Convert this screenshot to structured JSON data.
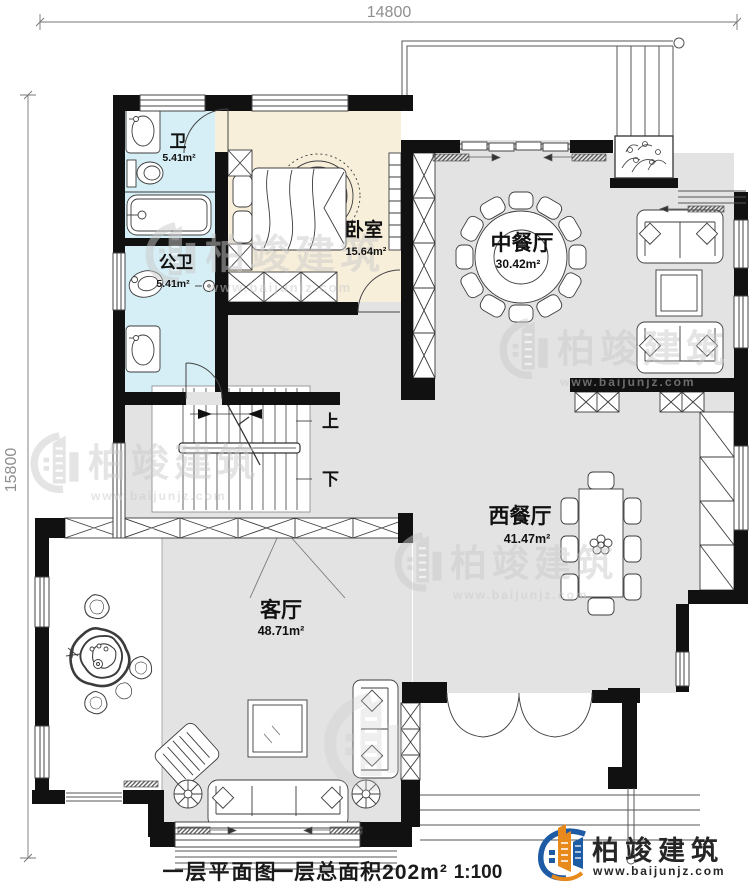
{
  "dimensions": {
    "top": "14800",
    "left": "15800"
  },
  "rooms": {
    "bath": {
      "name": "卫",
      "area": "5.41m²"
    },
    "public_bath": {
      "name": "公卫",
      "area": "5.41m²"
    },
    "bedroom": {
      "name": "卧室",
      "area": "15.64m²"
    },
    "chinese_dining": {
      "name": "中餐厅",
      "area": "30.42m²"
    },
    "western_dining": {
      "name": "西餐厅",
      "area": "41.47m²"
    },
    "living": {
      "name": "客厅",
      "area": "48.71m²"
    }
  },
  "stairs": {
    "up": "上",
    "down": "下"
  },
  "caption": {
    "plan_name": "一层平面图",
    "total_area": "一层总面积202m²",
    "scale": "1:100"
  },
  "brand": {
    "name": "柏竣建筑",
    "url": "www.baijunjz.com"
  },
  "watermark": {
    "name": "柏竣建筑",
    "url": "www.baijunjz.com"
  },
  "colors": {
    "wall": "#111111",
    "floor_gray": "#e3e3e3",
    "bath_cyan": "#d6eef5",
    "bedroom_cream": "#f8efdb",
    "brand_blue": "#1d5ca5",
    "brand_orange": "#e8891c"
  }
}
